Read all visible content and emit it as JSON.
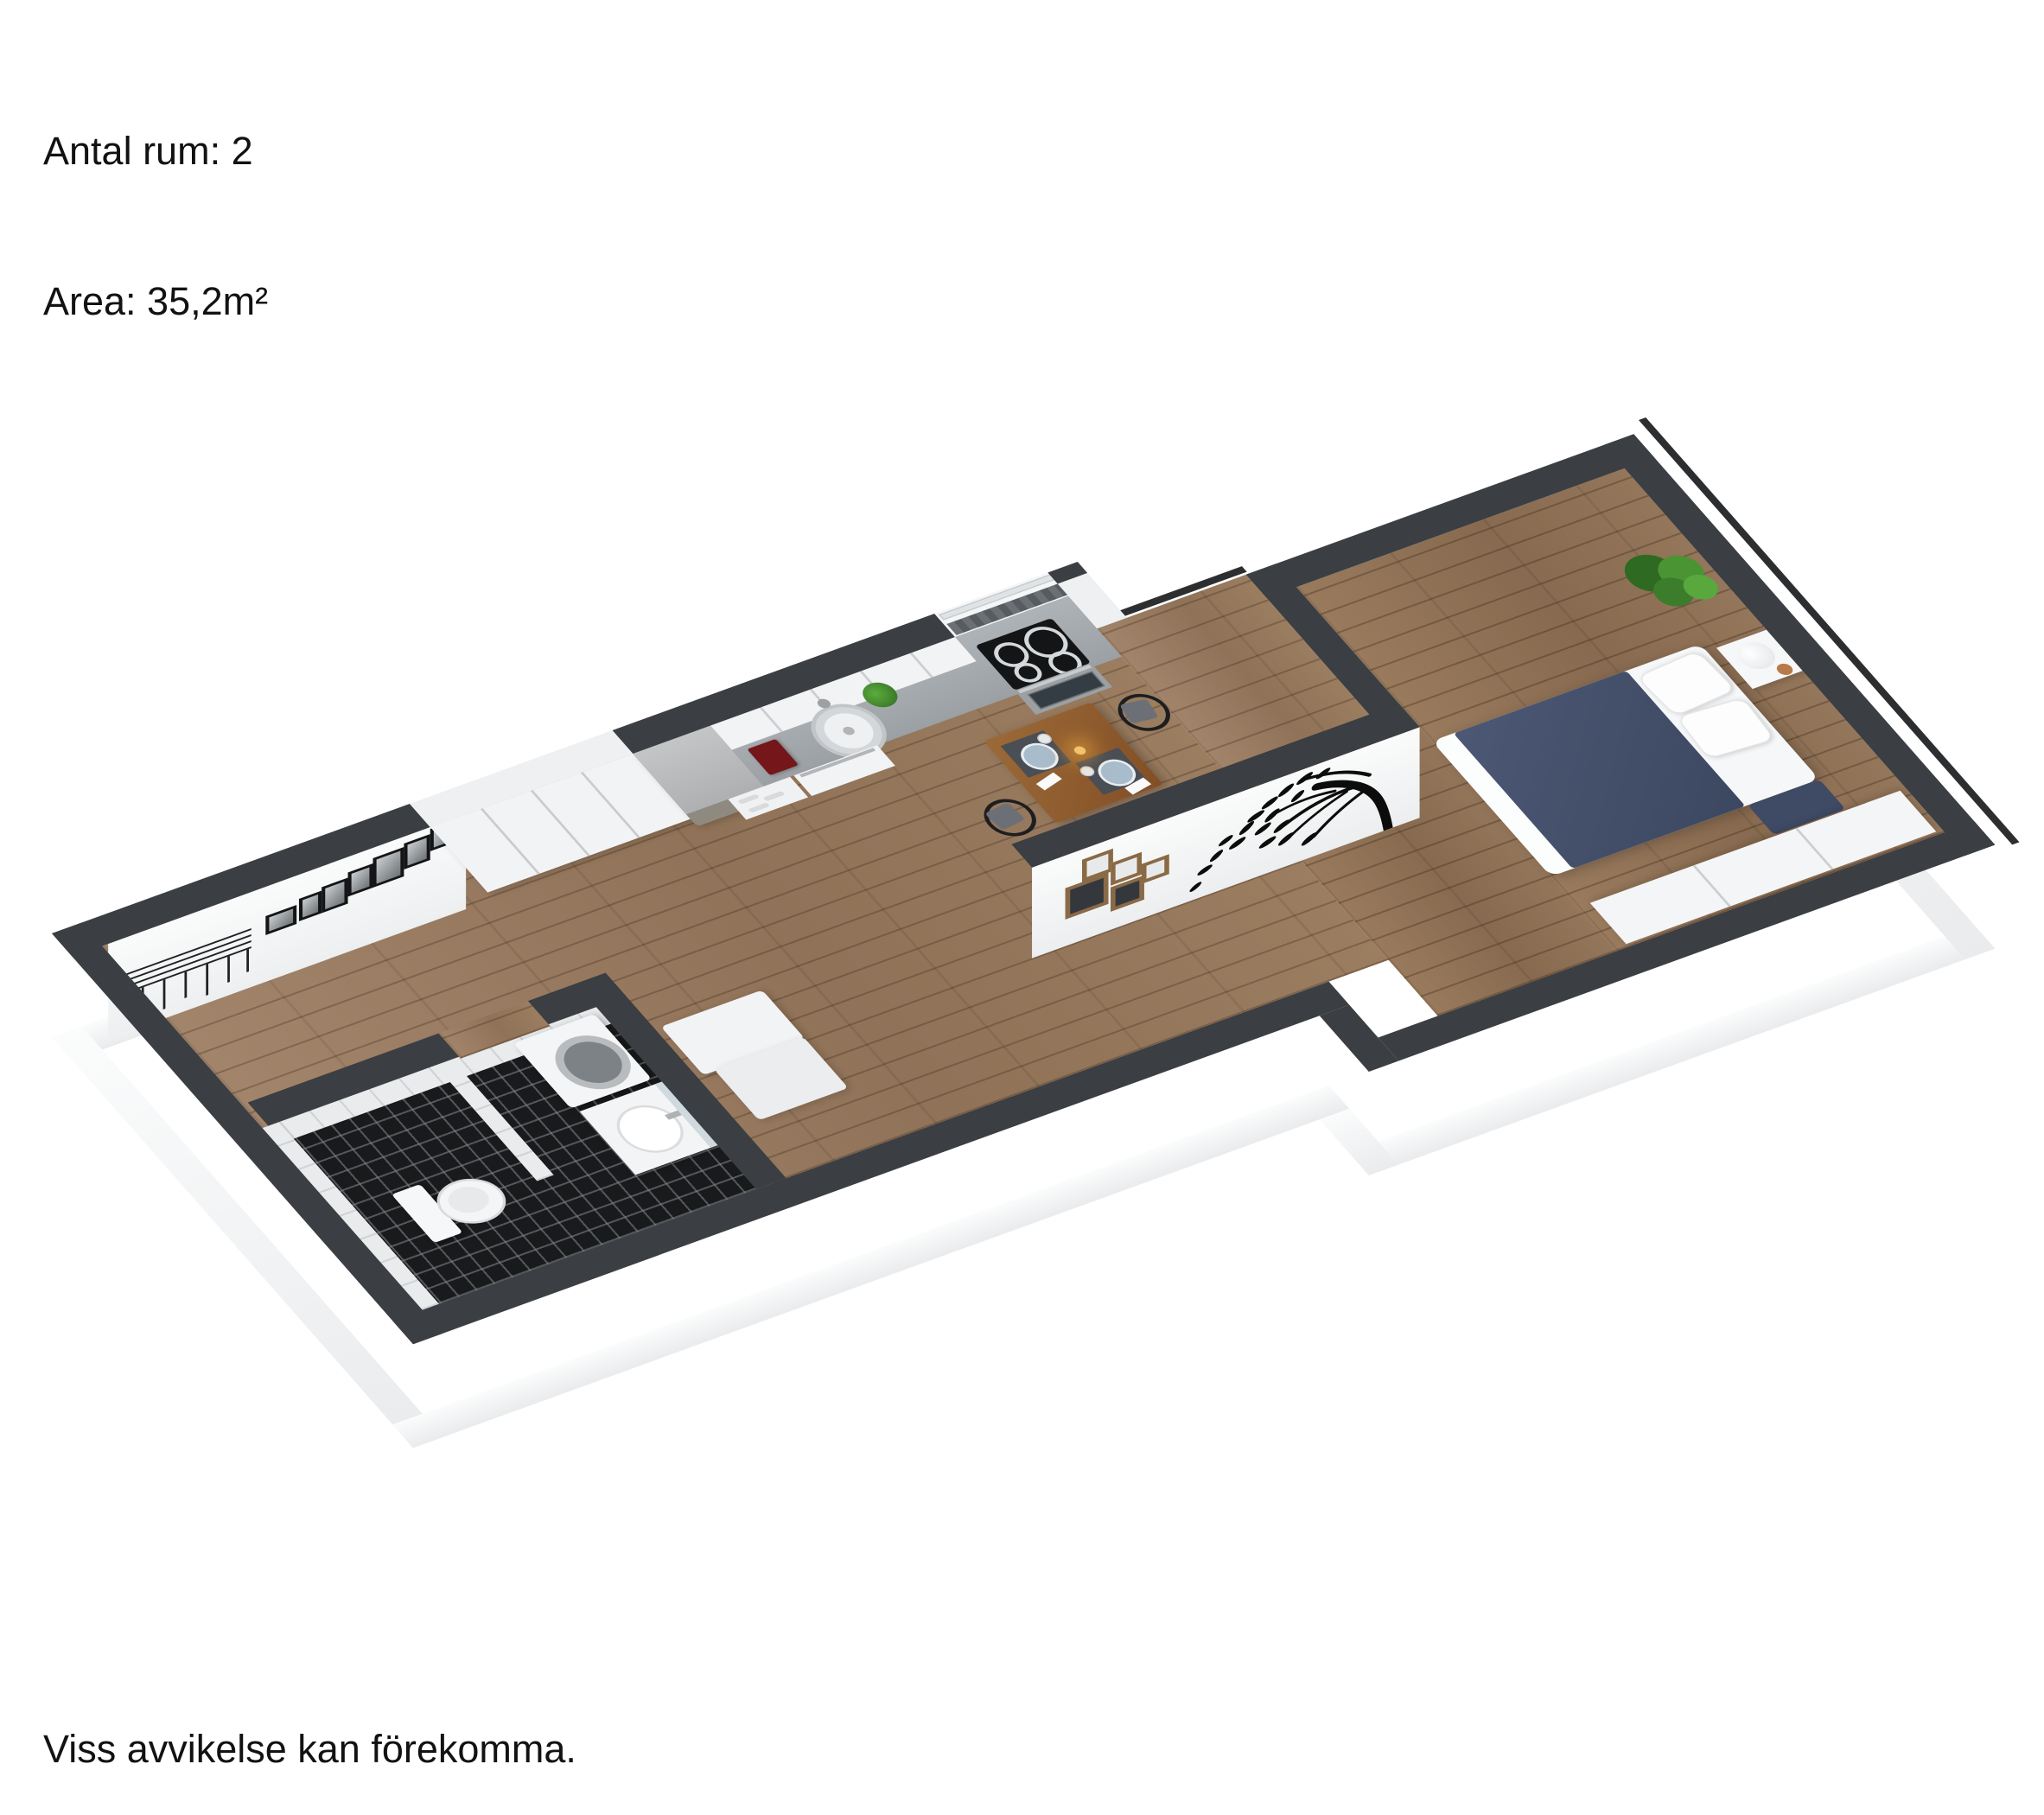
{
  "header": {
    "line1": "Antal rum: 2",
    "line2": "Area: 35,2m²"
  },
  "footer": {
    "disclaimer": "Viss avvikelse kan förekomma."
  },
  "plan": {
    "type": "3d-floorplan",
    "projection": "axonometric",
    "rooms": [
      "hall",
      "bathroom",
      "kitchen",
      "living-dining",
      "bedroom",
      "balcony"
    ],
    "furniture": [
      "wardrobes",
      "fridge",
      "kitchen-counter",
      "sink",
      "cooktop",
      "oven",
      "dishwasher",
      "coffee-maker",
      "dining-table",
      "wishbone-chairs",
      "picture-frames",
      "coat-rack",
      "toilet",
      "washing-machine",
      "vanity",
      "shower-partition",
      "bed",
      "pillows",
      "nightstand",
      "lamp",
      "plant",
      "dresser",
      "bench",
      "tree-wall-decal",
      "collage-frames"
    ],
    "palette": {
      "wall_top": "#3b3e42",
      "wall_face": "#f5f6f7",
      "floor_wood": "#9b7d60",
      "bath_floor": "#191a1c",
      "tile": "#e9ebec",
      "tile_grout": "#cfd3d6",
      "counter": "#a4a9ad",
      "cabinet": "#f2f3f5",
      "fridge_top": "#b6b9bb",
      "fridge_front": "#8f8a80",
      "bed_blanket": "#46526e",
      "table_wood": "#8f5d30",
      "placemat": "#4a4e55",
      "plate": "#a9bccb",
      "chair": "#1d1e20",
      "plant": "#44912f",
      "coffee_maker": "#74161a",
      "frame_brown": "#8a6a45",
      "decal": "#0c0c0c"
    }
  }
}
